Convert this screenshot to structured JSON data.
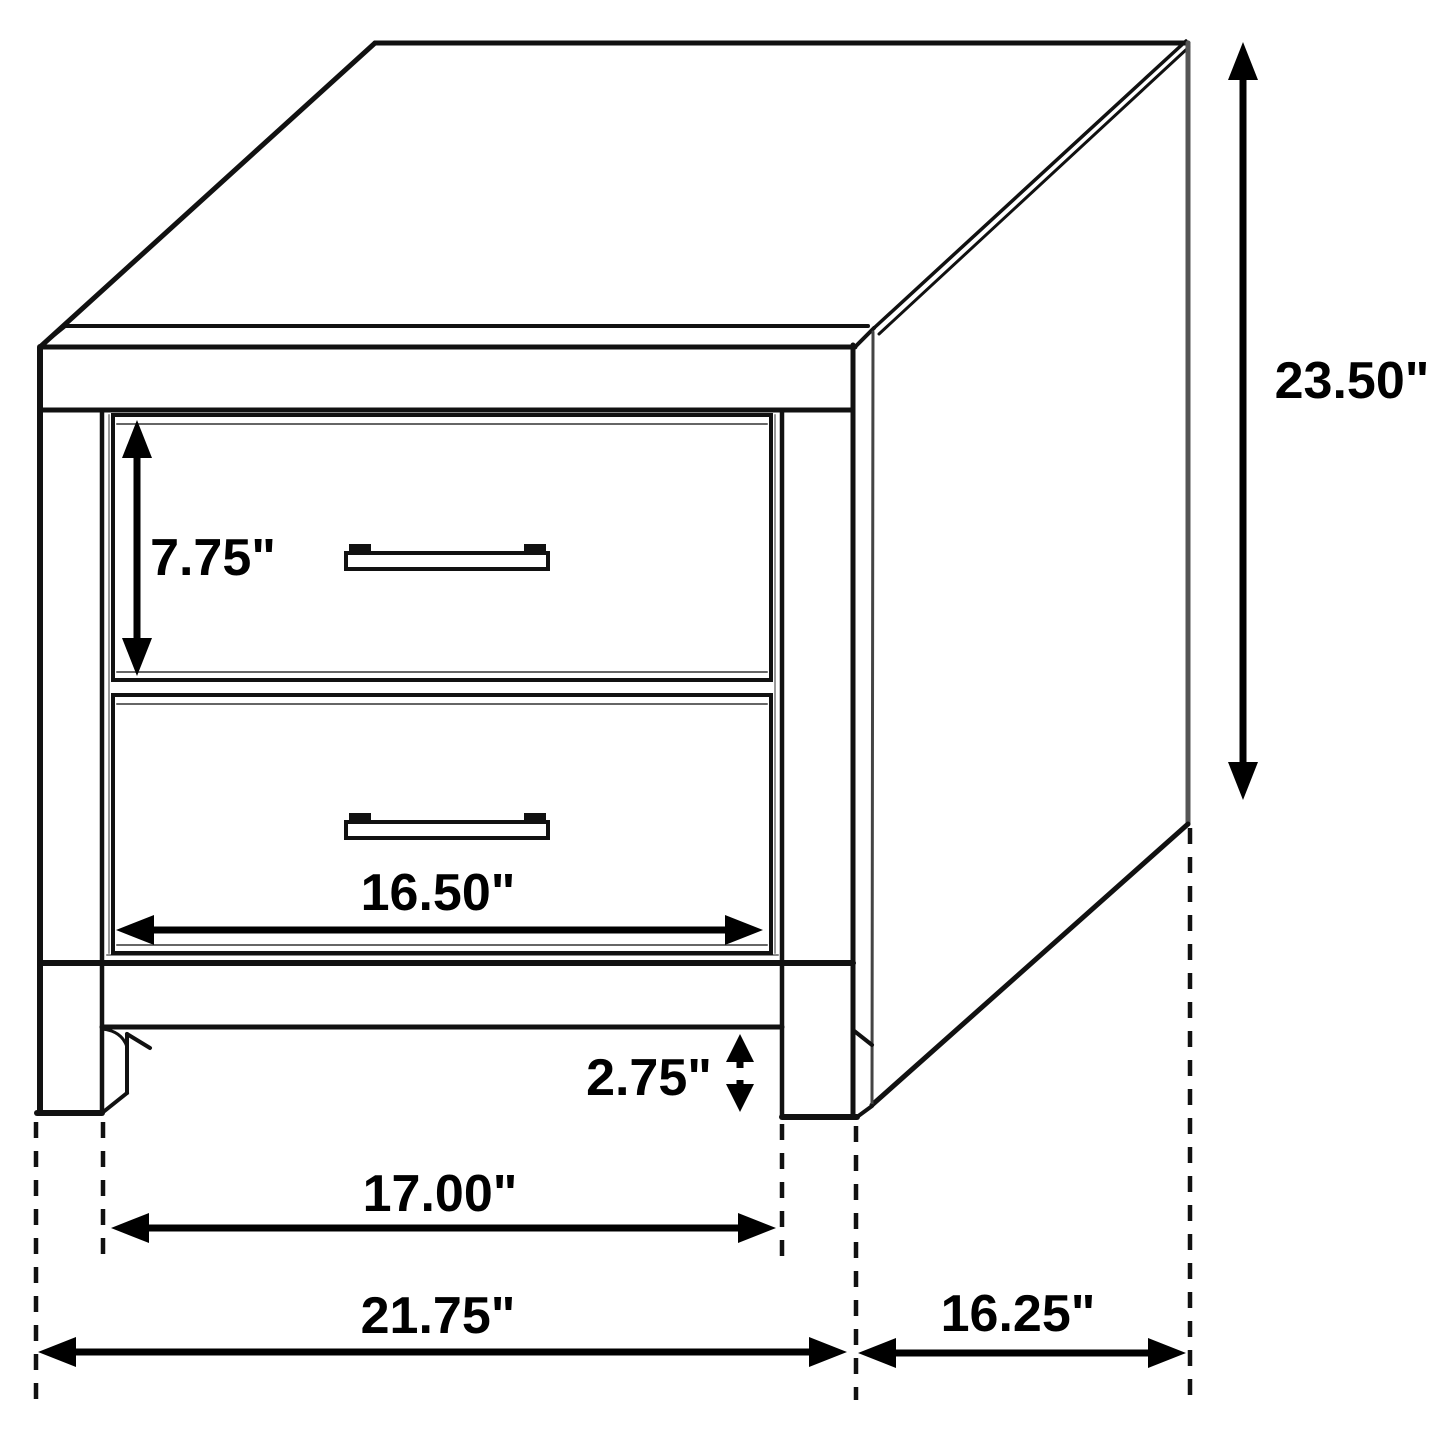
{
  "diagram": {
    "subject": "nightstand-two-drawer-dimension-drawing",
    "colors": {
      "line": "#111111",
      "background": "#ffffff",
      "dimension": "#000000",
      "soft_line": "#888888"
    },
    "dimensions": {
      "drawer_height": {
        "label": "7.75\""
      },
      "overall_height": {
        "label": "23.50\""
      },
      "drawer_width": {
        "label": "16.50\""
      },
      "leg_height": {
        "label": "2.75\""
      },
      "leg_spacing": {
        "label": "17.00\""
      },
      "overall_width": {
        "label": "21.75\""
      },
      "overall_depth": {
        "label": "16.25\""
      }
    }
  }
}
